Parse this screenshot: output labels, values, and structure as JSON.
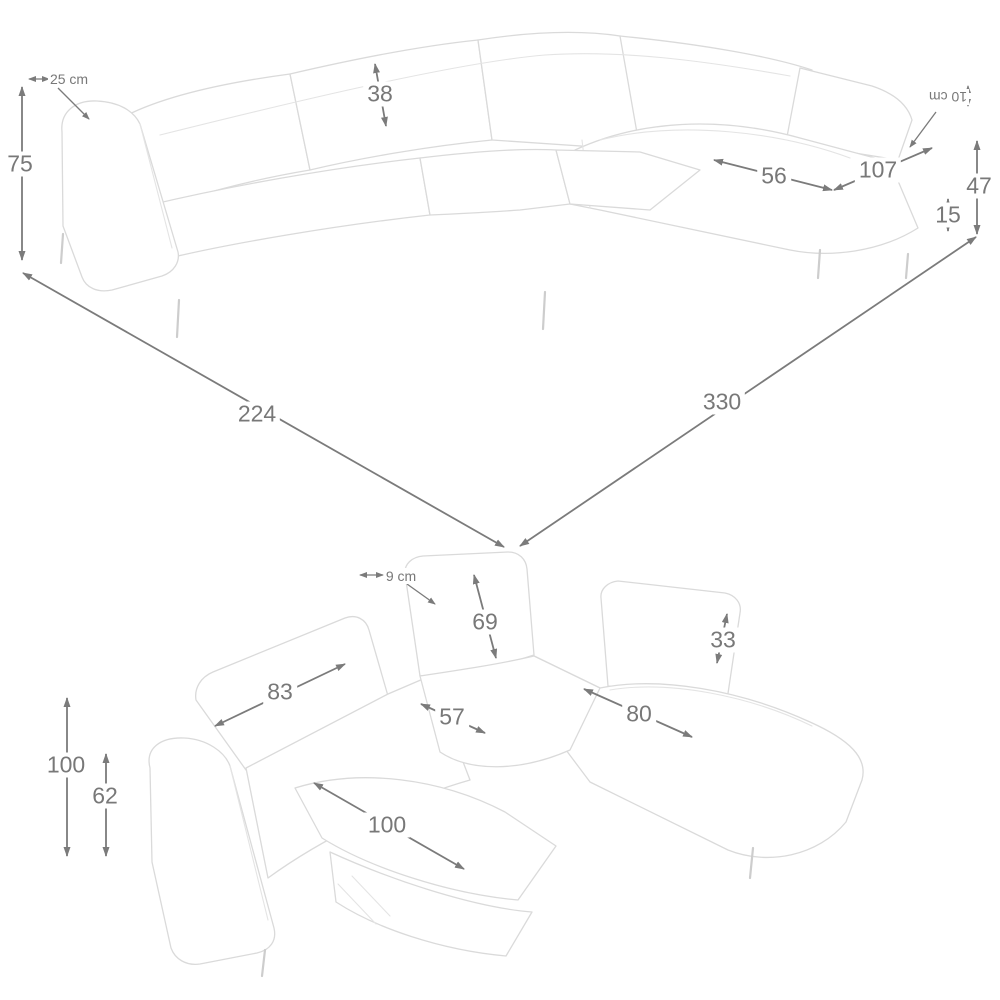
{
  "colors": {
    "dimension_accent": "#787878",
    "sketch_outline": "#dadada",
    "background": "#ffffff"
  },
  "top_view": {
    "armrest_width": "25 cm",
    "overall_height": "75",
    "backrest_height": "38",
    "chaise_seat_width": "56",
    "chaise_length": "107",
    "headrest_depth": "10 cm",
    "side_height": "47",
    "ground_clearance": "15",
    "width_left": "224",
    "width_right": "330"
  },
  "bottom_view": {
    "headrest_depth": "9 cm",
    "backrest_height": "69",
    "headrest_height": "33",
    "backrest_width": "83",
    "corner_seat_width": "57",
    "seat_width": "80",
    "overall_height": "100",
    "backrest_top_height": "62",
    "recliner_length": "100"
  }
}
